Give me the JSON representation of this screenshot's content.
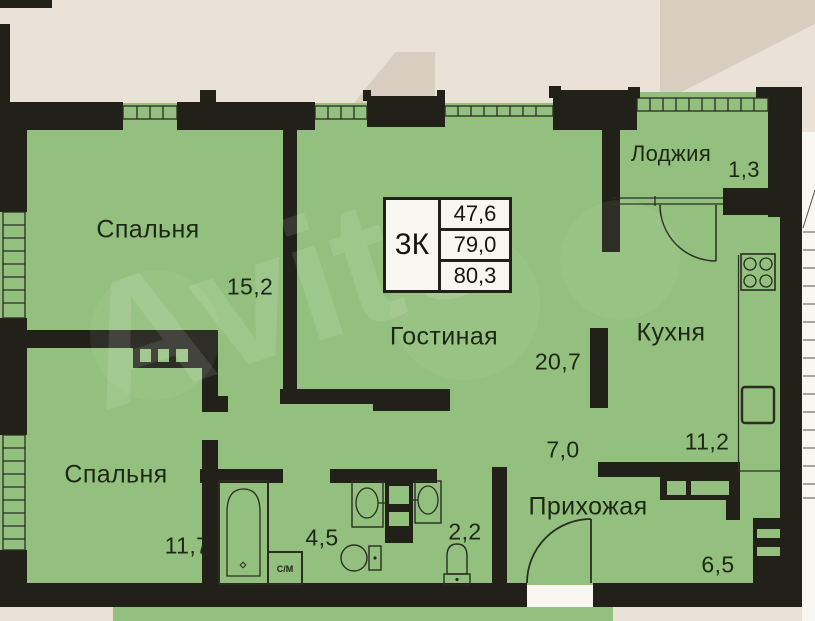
{
  "watermark": "Avito",
  "info_box": {
    "unit_type": "3К",
    "rows": [
      "47,6",
      "79,0",
      "80,3"
    ]
  },
  "rooms": {
    "bedroom_top": {
      "label": "Спальня",
      "area": "15,2"
    },
    "bedroom_bottom": {
      "label": "Спальня",
      "area": "11,7"
    },
    "living_room": {
      "label": "Гостиная",
      "area": "20,7"
    },
    "kitchen": {
      "label": "Кухня",
      "area": "11,2"
    },
    "loggia": {
      "label": "Лоджия",
      "area": "1,3"
    },
    "hallway": {
      "label": "Прихожая",
      "area": "6,5"
    },
    "corridor": {
      "area": "7,0"
    },
    "bathroom": {
      "area": "4,5"
    },
    "wc": {
      "area": "2,2"
    }
  },
  "fixtures": {
    "washing_machine_label": "С/М"
  },
  "colors": {
    "plan-green": "#93c07e",
    "wall": "#21211a",
    "beige": "#eae2d7",
    "beige-dark": "#d8cec0",
    "line": "#2a2d20",
    "white": "#f8f6f1",
    "label": "#1d2715",
    "watermark": "rgba(255,255,255,0.11)"
  }
}
